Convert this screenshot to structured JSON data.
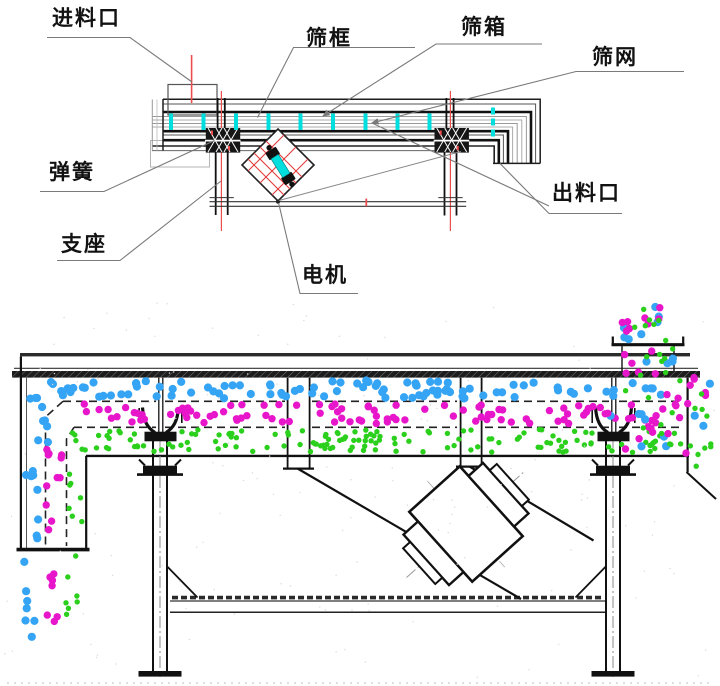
{
  "labels": {
    "feed_inlet": "进料口",
    "screen_frame": "筛框",
    "screen_box": "筛箱",
    "screen_mesh": "筛网",
    "spring": "弹簧",
    "discharge_outlet": "出料口",
    "support": "支座",
    "motor": "电机"
  },
  "colors": {
    "blue": "#35a4f4",
    "magenta": "#e816cb",
    "green": "#2bd01c",
    "cyan": "#00dede",
    "red": "#ee4d4d",
    "line": "#1a1a1a",
    "leader": "#7a7a7a"
  },
  "legend_semantics": {
    "blue": "large oversize particles on top deck",
    "magenta": "medium particles on middle deck",
    "green": "fine particles on bottom deck",
    "cyan": "screen mesh ticks / exciter cylinder",
    "red": "center lines"
  },
  "top_diagram": {
    "tick_xs": [
      171,
      203.5,
      236,
      268.5,
      300.5,
      333,
      365.5,
      397.5,
      429.5
    ],
    "tick_y": 113.5,
    "tick_h": 16.5,
    "discharge_tick_x": 491,
    "discharge_tick_ys": [
      107.5,
      118.5,
      129.5
    ]
  },
  "particle_layers": [
    {
      "name": "oversize-layer",
      "c": "blue",
      "rect": [
        34,
        380.5,
        644,
        18
      ],
      "n": 100,
      "r": 4.1,
      "seed": 101
    },
    {
      "name": "middlings-layer",
      "c": "magenta",
      "rect": [
        70,
        403.5,
        608,
        20
      ],
      "n": 100,
      "r": 3.7,
      "seed": 102
    },
    {
      "name": "fines-layer",
      "c": "green",
      "rect": [
        82,
        429.5,
        596,
        23
      ],
      "n": 155,
      "r": 2.7,
      "seed": 103
    },
    {
      "name": "oversize-bend",
      "c": "blue",
      "rect": [
        26,
        396,
        22,
        48
      ],
      "n": 8,
      "r": 4.1,
      "seed": 104
    },
    {
      "name": "oversize-chute",
      "c": "blue",
      "rect": [
        24,
        444,
        15,
        100
      ],
      "n": 8,
      "r": 4.1,
      "seed": 105
    },
    {
      "name": "oversize-fall",
      "c": "blue",
      "rect": [
        24,
        552,
        13,
        86
      ],
      "n": 7,
      "r": 4.1,
      "seed": 106
    },
    {
      "name": "middlings-chute",
      "c": "magenta",
      "rect": [
        46,
        410,
        16,
        134
      ],
      "n": 11,
      "r": 3.7,
      "seed": 107
    },
    {
      "name": "middlings-fall",
      "c": "magenta",
      "rect": [
        46,
        552,
        15,
        78
      ],
      "n": 7,
      "r": 3.7,
      "seed": 108
    },
    {
      "name": "fines-chute",
      "c": "green",
      "rect": [
        65,
        422,
        18,
        122
      ],
      "n": 11,
      "r": 2.7,
      "seed": 109
    },
    {
      "name": "fines-fall",
      "c": "green",
      "rect": [
        64,
        552,
        16,
        66
      ],
      "n": 7,
      "r": 2.7,
      "seed": 110
    },
    {
      "name": "feed-stream-blue",
      "c": "blue",
      "rect": [
        619,
        302,
        54,
        74
      ],
      "n": 11,
      "r": 4.1,
      "seed": 111
    },
    {
      "name": "feed-stream-magenta",
      "c": "magenta",
      "rect": [
        616,
        299,
        58,
        78
      ],
      "n": 14,
      "r": 3.7,
      "seed": 112
    },
    {
      "name": "feed-stream-green",
      "c": "green",
      "rect": [
        618,
        299,
        58,
        78
      ],
      "n": 14,
      "r": 2.7,
      "seed": 113
    },
    {
      "name": "feed-spread-blue",
      "c": "blue",
      "rect": [
        606,
        379,
        74,
        70
      ],
      "n": 9,
      "r": 4.1,
      "seed": 114
    },
    {
      "name": "feed-spread-magenta",
      "c": "magenta",
      "rect": [
        604,
        379,
        80,
        72
      ],
      "n": 12,
      "r": 3.7,
      "seed": 115
    },
    {
      "name": "feed-spread-green",
      "c": "green",
      "rect": [
        606,
        379,
        78,
        74
      ],
      "n": 12,
      "r": 2.7,
      "seed": 116
    },
    {
      "name": "overflow-blue",
      "c": "blue",
      "rect": [
        688,
        374,
        24,
        58
      ],
      "n": 3,
      "r": 4.1,
      "seed": 117
    },
    {
      "name": "overflow-magenta",
      "c": "magenta",
      "rect": [
        686,
        372,
        27,
        92
      ],
      "n": 7,
      "r": 3.7,
      "seed": 118
    },
    {
      "name": "overflow-green",
      "c": "green",
      "rect": [
        688,
        378,
        27,
        90
      ],
      "n": 10,
      "r": 2.7,
      "seed": 119
    }
  ],
  "particle_avoid_rects": [
    [
      140,
      424,
      42,
      20
    ],
    [
      593,
      424,
      42,
      20
    ]
  ],
  "speckles": {
    "n": 150,
    "seed": 77,
    "row_y": 683,
    "row_step": 7
  }
}
